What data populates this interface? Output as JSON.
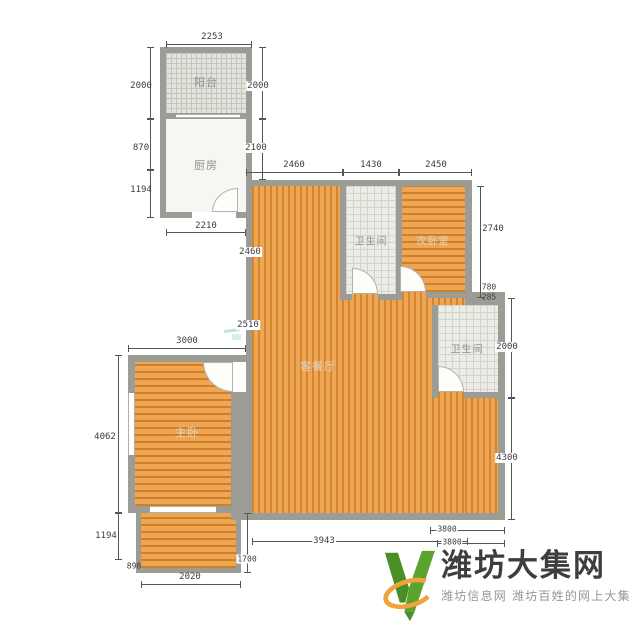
{
  "rooms": {
    "balcony": "阳台",
    "kitchen": "厨房",
    "bath_center": "卫生间",
    "bedroom_small": "次卧室",
    "bath_right": "卫生间",
    "living": "客餐厅",
    "bedroom_master": "主卧"
  },
  "dims": {
    "balcony_top": "2253",
    "balcony_left": "2000",
    "balcony_right": "2000",
    "kitchen_left_a": "870",
    "kitchen_left_b": "1194",
    "kitchen_right": "2100",
    "below_kitchen": "2210",
    "living_left_a": "2460",
    "living_left_b": "2510",
    "top_a": "2460",
    "top_b": "1430",
    "top_c": "2450",
    "bed2_right": "2740",
    "step_a": "780",
    "step_b": "285",
    "right_a": "2000",
    "right_b": "4300",
    "bed1_top": "3000",
    "bed1_left": "4062",
    "lower_left_a": "1194",
    "lower_left_b": "898",
    "balcony2_bottom": "2020",
    "balcony2_right": "1700",
    "bottom_mid": "3943",
    "bottom_r_a": "3800",
    "bottom_r_b": "3800"
  },
  "logo": {
    "title": "潍坊大集网",
    "subtitle": "潍坊信息网 潍坊百姓的网上大集",
    "brand_green": "#5ba32e",
    "brand_green_dark": "#4a8f25",
    "brand_orange": "#f0a23c",
    "title_color": "#3e3e3e",
    "subtitle_color": "#8e9a97"
  },
  "colors": {
    "wood_floor": "#e69740",
    "wall": "#9c9c97",
    "tile_room": "#ecece7",
    "dim_text": "#3c3c3c"
  }
}
